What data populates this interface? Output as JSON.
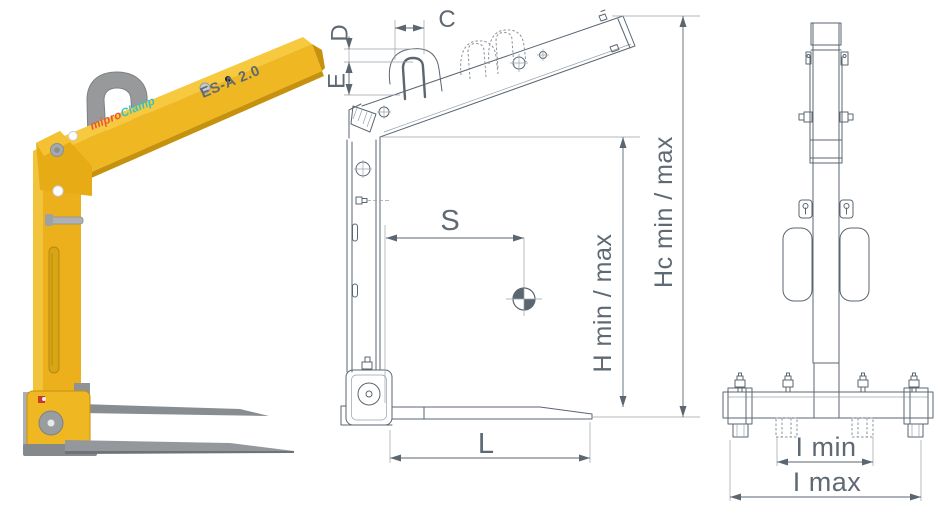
{
  "product_photo": {
    "brand_primary": "mipro",
    "brand_secondary": "Clamp",
    "model_label": "ES-A 2.0"
  },
  "side_view": {
    "dim_c": "C",
    "dim_d": "D",
    "dim_e": "E",
    "dim_s": "S",
    "dim_l": "L",
    "dim_h": "H min / max",
    "dim_hc": "Hc min / max"
  },
  "front_view": {
    "dim_i_min": "I min",
    "dim_i_max": "I max"
  },
  "icons": {
    "center_of_gravity": "center-of-gravity-icon",
    "lifting_eye": "lifting-eye-shackle"
  },
  "colors": {
    "background": "#FFFFFF",
    "body_yellow": "#EFB722",
    "body_yellow_light": "#F6C93F",
    "body_yellow_dark": "#C6920D",
    "metal_gray": "#97999B",
    "fork_gray": "#8A8E92",
    "drawing_line": "#5B6671",
    "dimension_text": "#5F6973",
    "brand_primary_color": "#E4573D",
    "brand_secondary_color": "#35C2C5",
    "model_text_color": "#141414",
    "accent_red": "#C93A2E"
  }
}
